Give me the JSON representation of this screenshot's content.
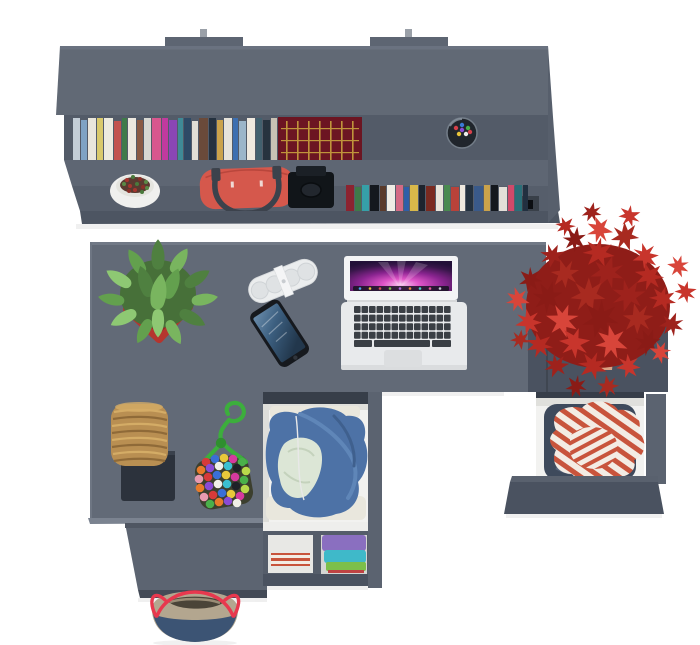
{
  "scene": {
    "type": "3d-render-top-view-desk-workstation",
    "background": "#ffffff"
  },
  "colors": {
    "shelf_panel": "#616975",
    "shelf_tab": "#5d6572",
    "shelf_recess": "#535b68",
    "shelf_divider": "#5e6673",
    "shelf_lower": "#565e6b",
    "shelf_front": "#4d5562",
    "shelf_side": "#575f6c",
    "metal": "#9aa0a8",
    "desk": "#626a77",
    "desk_edge": "#717986",
    "platform_edge": "#7b8390",
    "pedestal": "#5c6471",
    "pedestal_front": "#434a56",
    "cabinet": "#4a5260",
    "cabinet_edge": "#59616e",
    "drawer_front": "#4a5260",
    "rail": "#5b6370",
    "slot": "#373e49",
    "drawer_interior": "#f2f2f0",
    "interior_shade": "#e0e0dc",
    "book_set": "#6c1522",
    "book_set_gold": "#c9a23e",
    "handbag": "#d5584c",
    "strap": "#3c424c",
    "camera": "#111519",
    "pot_white": "#f0f0ee",
    "pot_red": "#b5352e",
    "pot_red_dark": "#922b26",
    "pot_terracotta": "#d9a183",
    "pot_terracotta_dark": "#c08a6f",
    "succulent_base": "#477039",
    "maple_base": "#8f1d18",
    "speaker": "#ebedee",
    "speaker_hole": "#dfe2e4",
    "phone": "#16191e",
    "phone_home": "#30353c",
    "laptop_body": "#e8eaec",
    "laptop_bezel": "#f3f4f5",
    "key": "#3a3f45",
    "trackpad": "#dcdee0",
    "hinge": "#d5d7d9",
    "denim": "#3e4a5c",
    "denim_fold": "#55637a",
    "hoodie": "#4d72a6",
    "hoodie_light": "#5f86b8",
    "hoodie_dark": "#3f608e",
    "hoodie_lining": "#dce6d6",
    "white_clothes": "#e9e7dd",
    "shirt_stripe": "#c8543c",
    "shirt_white": "#f3ece4",
    "wicker": "#b98f52",
    "wicker_dark": "#8f6a38",
    "wicker_light": "#d4ac66",
    "stool_base": "#2c323c",
    "rope": "#3cae3c",
    "rope_dark": "#2f8f2f",
    "pompom_backing": "#3c3f2e",
    "tote_navy": "#3c5474",
    "tote_tan": "#b3a68f",
    "tote_strap": "#e8384e",
    "tote_interior": "#4a4438",
    "cubby_purple": "#8a6fc0",
    "cubby_teal": "#3fb9c9",
    "cubby_green": "#7cbf4a",
    "cubby_red": "#c04343"
  },
  "shelf": {
    "upper_books": {
      "x": 73,
      "y": 118,
      "h": 47,
      "gap": 1,
      "items": [
        {
          "w": 7,
          "c": "#c3cdd6"
        },
        {
          "w": 6,
          "c": "#7fa3c4",
          "dy": 2
        },
        {
          "w": 8,
          "c": "#e9e6db"
        },
        {
          "w": 6,
          "c": "#d9c96a"
        },
        {
          "w": 9,
          "c": "#eceade"
        },
        {
          "w": 7,
          "c": "#c2524e",
          "dy": 3
        },
        {
          "w": 5,
          "c": "#3f7a49"
        },
        {
          "w": 8,
          "c": "#ece8df"
        },
        {
          "w": 6,
          "c": "#8a5a44",
          "dy": 2
        },
        {
          "w": 7,
          "c": "#d8d8d2"
        },
        {
          "w": 9,
          "c": "#d8578e"
        },
        {
          "w": 6,
          "c": "#c03a9e"
        },
        {
          "w": 8,
          "c": "#8a46b5",
          "dy": 2
        },
        {
          "w": 5,
          "c": "#3f8a96"
        },
        {
          "w": 7,
          "c": "#2e4a66"
        },
        {
          "w": 6,
          "c": "#e2dfd6",
          "dy": 3
        },
        {
          "w": 9,
          "c": "#6a4a3a"
        },
        {
          "w": 7,
          "c": "#24313f"
        },
        {
          "w": 6,
          "c": "#caa24a",
          "dy": 2
        },
        {
          "w": 8,
          "c": "#e6e3da"
        },
        {
          "w": 5,
          "c": "#3d6fb0"
        },
        {
          "w": 7,
          "c": "#9bb5c9",
          "dy": 3
        },
        {
          "w": 8,
          "c": "#efe9df"
        },
        {
          "w": 6,
          "c": "#42606e"
        },
        {
          "w": 7,
          "c": "#27333f",
          "dy": 2
        },
        {
          "w": 6,
          "c": "#c8c2b4"
        }
      ]
    },
    "lower_books": {
      "x": 346,
      "y": 185,
      "h": 27,
      "gap": 1,
      "items": [
        {
          "w": 8,
          "c": "#8c2330"
        },
        {
          "w": 6,
          "c": "#3f7a49",
          "dy": 2
        },
        {
          "w": 7,
          "c": "#36a0a8"
        },
        {
          "w": 9,
          "c": "#14181e"
        },
        {
          "w": 6,
          "c": "#5a3a2a",
          "dy": 1
        },
        {
          "w": 8,
          "c": "#efece4"
        },
        {
          "w": 7,
          "c": "#d46a84"
        },
        {
          "w": 5,
          "c": "#2f5fa8",
          "dy": 2
        },
        {
          "w": 8,
          "c": "#d8b84a"
        },
        {
          "w": 6,
          "c": "#1d242e"
        },
        {
          "w": 9,
          "c": "#7a2a20",
          "dy": 1
        },
        {
          "w": 7,
          "c": "#e8e4da"
        },
        {
          "w": 6,
          "c": "#4a8a50"
        },
        {
          "w": 8,
          "c": "#b8423a",
          "dy": 2
        },
        {
          "w": 5,
          "c": "#efe9df"
        },
        {
          "w": 7,
          "c": "#24313f"
        },
        {
          "w": 9,
          "c": "#3a5a8a",
          "dy": 1
        },
        {
          "w": 6,
          "c": "#caa24a"
        },
        {
          "w": 7,
          "c": "#14181e"
        },
        {
          "w": 8,
          "c": "#e2dfd8",
          "dy": 2
        },
        {
          "w": 6,
          "c": "#d04a6a"
        },
        {
          "w": 7,
          "c": "#2a6f78"
        },
        {
          "w": 5,
          "c": "#223040"
        }
      ]
    },
    "pen_dots": {
      "r": 2.2,
      "colors": [
        "#d6404a",
        "#3a7ad6",
        "#46b04a",
        "#e8c43a",
        "#ececec",
        "#8a4ad6",
        "#d6404a"
      ],
      "points": [
        [
          456,
          128
        ],
        [
          462,
          125
        ],
        [
          468,
          128
        ],
        [
          459,
          134
        ],
        [
          466,
          134
        ],
        [
          462,
          130
        ],
        [
          470,
          132
        ]
      ]
    }
  },
  "plants": {
    "flower_dots": {
      "r": 2,
      "colors": [
        "#a8352f",
        "#4a7a3c",
        "#8a2f28",
        "#5a8a46"
      ],
      "points": [
        [
          127,
          180
        ],
        [
          133,
          177
        ],
        [
          140,
          179
        ],
        [
          146,
          182
        ],
        [
          130,
          186
        ],
        [
          137,
          184
        ],
        [
          143,
          187
        ],
        [
          124,
          184
        ],
        [
          135,
          190
        ],
        [
          142,
          192
        ],
        [
          129,
          191
        ],
        [
          147,
          188
        ]
      ]
    },
    "succulent": {
      "path": "M0,-13 C3.5,-9 5,-3 3.5,3 C2.5,7 -2.5,7 -3.5,3 C-5,-3 -3.5,-9 0,-13 Z",
      "colors": [
        "#4f8040",
        "#63a04e",
        "#79b55f",
        "#8ec873"
      ],
      "items": [
        [
          158,
          260,
          1.6,
          0
        ],
        [
          139,
          266,
          1.5,
          -32
        ],
        [
          177,
          265,
          1.5,
          32
        ],
        [
          123,
          281,
          1.5,
          -58
        ],
        [
          193,
          281,
          1.5,
          58
        ],
        [
          116,
          300,
          1.4,
          -80
        ],
        [
          200,
          300,
          1.4,
          80
        ],
        [
          128,
          316,
          1.5,
          -118
        ],
        [
          188,
          316,
          1.5,
          118
        ],
        [
          146,
          327,
          1.4,
          -152
        ],
        [
          172,
          328,
          1.4,
          152
        ],
        [
          158,
          318,
          1.5,
          180
        ],
        [
          147,
          287,
          1.7,
          -18
        ],
        [
          170,
          289,
          1.7,
          22
        ],
        [
          158,
          298,
          1.9,
          8
        ]
      ]
    },
    "maple": {
      "path": "M0,-11 L2.2,-3.5 L8.5,-7 L4.5,-1 L11,1.5 L4,3 L5.5,10 L0.8,4.5 L-3.5,11 L-3.8,4 L-10.5,6 L-5.5,0 L-10,-4.5 L-3,-3 Z",
      "colors": [
        "#9e221c",
        "#b52a22",
        "#c8352c",
        "#d8453a",
        "#8a1b16",
        "#a82a20"
      ],
      "items": [
        [
          592,
          212,
          0.9,
          10
        ],
        [
          566,
          226,
          0.9,
          40
        ],
        [
          630,
          216,
          1.0,
          70
        ],
        [
          600,
          230,
          1.2,
          100
        ],
        [
          575,
          240,
          1.1,
          130
        ],
        [
          625,
          237,
          1.3,
          160
        ],
        [
          552,
          256,
          1.1,
          190
        ],
        [
          598,
          253,
          1.4,
          220
        ],
        [
          645,
          256,
          1.2,
          250
        ],
        [
          678,
          266,
          1.0,
          280
        ],
        [
          530,
          279,
          1.1,
          310
        ],
        [
          565,
          273,
          1.3,
          340
        ],
        [
          608,
          272,
          1.5,
          15
        ],
        [
          650,
          276,
          1.3,
          45
        ],
        [
          686,
          292,
          1.0,
          75
        ],
        [
          518,
          300,
          1.1,
          105
        ],
        [
          548,
          298,
          1.4,
          135
        ],
        [
          588,
          296,
          1.6,
          165
        ],
        [
          628,
          296,
          1.5,
          195
        ],
        [
          662,
          299,
          1.2,
          225
        ],
        [
          528,
          322,
          1.2,
          255
        ],
        [
          562,
          320,
          1.5,
          285
        ],
        [
          600,
          318,
          1.7,
          315
        ],
        [
          638,
          318,
          1.4,
          345
        ],
        [
          672,
          324,
          1.1,
          20
        ],
        [
          540,
          345,
          1.2,
          50
        ],
        [
          575,
          343,
          1.4,
          80
        ],
        [
          612,
          343,
          1.5,
          110
        ],
        [
          648,
          343,
          1.2,
          140
        ],
        [
          520,
          340,
          0.9,
          170
        ],
        [
          556,
          366,
          1.1,
          200
        ],
        [
          592,
          366,
          1.3,
          230
        ],
        [
          628,
          366,
          1.1,
          260
        ],
        [
          660,
          352,
          1.0,
          290
        ],
        [
          576,
          386,
          1.0,
          320
        ],
        [
          608,
          386,
          1.0,
          350
        ]
      ]
    }
  },
  "pompoms": {
    "r": 4.3,
    "colors": [
      "#d63a3a",
      "#3a6fd6",
      "#e8c83a",
      "#d63a9e",
      "#4ab04a",
      "#e87a2a",
      "#8a4ad6",
      "#f0efe8",
      "#3ac0d0",
      "#1e2228",
      "#b8d84a",
      "#e89ab0"
    ],
    "points": [
      [
        206,
        462
      ],
      [
        215,
        459
      ],
      [
        224,
        458
      ],
      [
        233,
        459
      ],
      [
        242,
        462
      ],
      [
        201,
        470
      ],
      [
        210,
        468
      ],
      [
        219,
        466
      ],
      [
        228,
        466
      ],
      [
        237,
        468
      ],
      [
        246,
        471
      ],
      [
        199,
        479
      ],
      [
        208,
        477
      ],
      [
        217,
        475
      ],
      [
        226,
        475
      ],
      [
        235,
        477
      ],
      [
        244,
        480
      ],
      [
        200,
        488
      ],
      [
        209,
        486
      ],
      [
        218,
        484
      ],
      [
        227,
        484
      ],
      [
        236,
        486
      ],
      [
        245,
        489
      ],
      [
        204,
        497
      ],
      [
        213,
        495
      ],
      [
        222,
        493
      ],
      [
        231,
        494
      ],
      [
        240,
        496
      ],
      [
        210,
        504
      ],
      [
        219,
        502
      ],
      [
        228,
        501
      ],
      [
        237,
        503
      ]
    ]
  },
  "laptop": {
    "keys": {
      "x": 354,
      "y": 306,
      "rows": 4,
      "cols": 13,
      "kw": 6.6,
      "kh": 7,
      "gx": 0.9,
      "gy": 1.6,
      "fill": "#3a3f45"
    },
    "dock_dots": {
      "r": 1.3,
      "colors": [
        "#4aa3e8",
        "#e8c43a",
        "#d65454",
        "#7ac04a",
        "#b06ae0",
        "#e88a3a",
        "#4ad0c8",
        "#e85a9a",
        "#c8ccd4"
      ],
      "points": [
        [
          360,
          288.5
        ],
        [
          370,
          288.5
        ],
        [
          380,
          288.5
        ],
        [
          390,
          288.5
        ],
        [
          400,
          288.5
        ],
        [
          410,
          288.5
        ],
        [
          420,
          288.5
        ],
        [
          430,
          288.5
        ],
        [
          440,
          288.5
        ]
      ]
    }
  },
  "objects": [
    {
      "name": "wall-shelf",
      "color": "#616975"
    },
    {
      "name": "books-upper-row",
      "count": 26
    },
    {
      "name": "antique-book-set",
      "colors": [
        "#6c1522",
        "#c9a23e"
      ]
    },
    {
      "name": "pen-cup",
      "color": "#20252c"
    },
    {
      "name": "potted-flower",
      "colors": [
        "#f0f0ee",
        "#a8352f"
      ]
    },
    {
      "name": "red-handbag",
      "color": "#d5584c"
    },
    {
      "name": "camera",
      "color": "#111519"
    },
    {
      "name": "books-lower-row",
      "count": 23
    },
    {
      "name": "desk",
      "color": "#626a77"
    },
    {
      "name": "succulent-plant-in-red-pot",
      "colors": [
        "#63a04e",
        "#b5352e"
      ]
    },
    {
      "name": "portable-speaker",
      "color": "#ebedee"
    },
    {
      "name": "smartphone",
      "color": "#16191e"
    },
    {
      "name": "laptop",
      "colors": [
        "#e8eaec",
        "#d03ab8"
      ]
    },
    {
      "name": "red-maple-plant-in-terracotta-pot",
      "colors": [
        "#c8352c",
        "#d9a183"
      ]
    },
    {
      "name": "side-cabinet",
      "color": "#4a5260"
    },
    {
      "name": "open-drawer-with-striped-shirt",
      "colors": [
        "#c8543c",
        "#f3ece4",
        "#3e4a5c"
      ]
    },
    {
      "name": "open-drawer-with-blue-hoodie",
      "colors": [
        "#4d72a6",
        "#dce6d6"
      ]
    },
    {
      "name": "cubby-with-folded-clothes",
      "colors": [
        "#8a6fc0",
        "#3fb9c9",
        "#7cbf4a"
      ]
    },
    {
      "name": "wicker-stool",
      "color": "#b98f52"
    },
    {
      "name": "pompom-pouch",
      "colors": [
        "#3cae3c"
      ]
    },
    {
      "name": "tote-bag",
      "colors": [
        "#3c5474",
        "#b3a68f",
        "#e8384e"
      ]
    }
  ]
}
